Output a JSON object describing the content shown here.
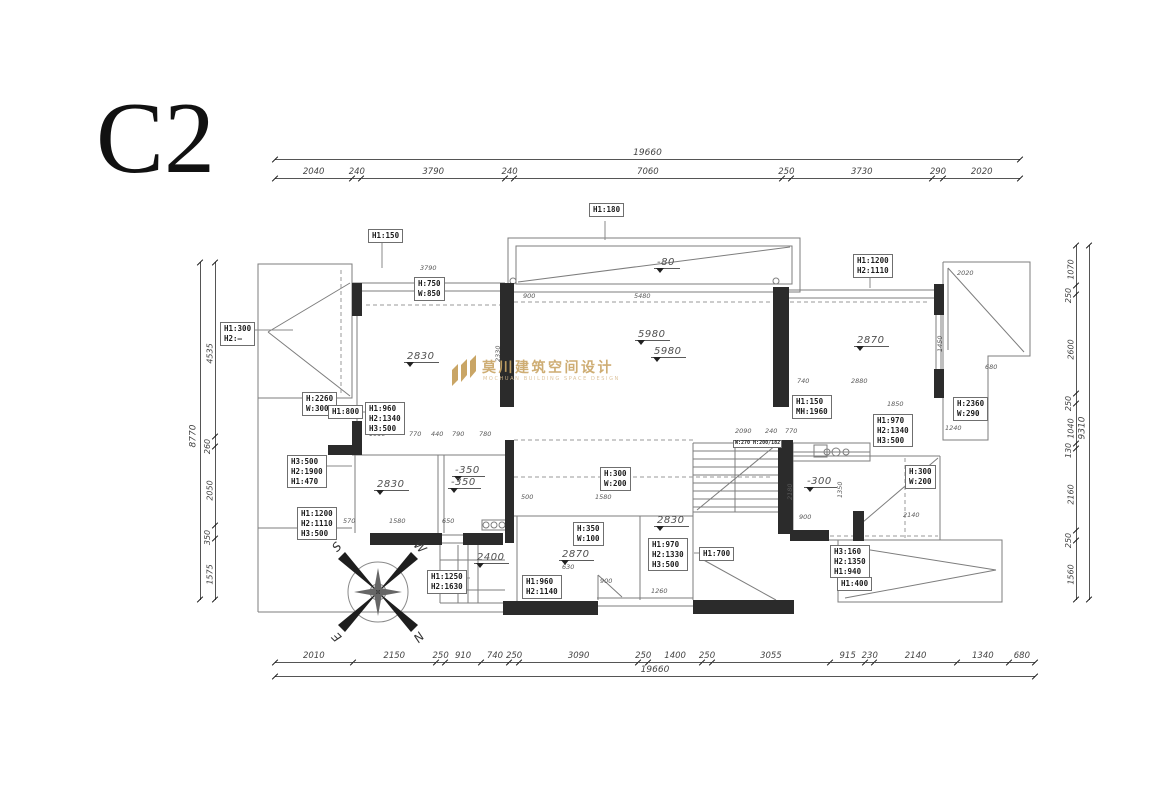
{
  "title": "C2",
  "watermark": {
    "logo_cn": "莫川建筑空间设计",
    "logo_en": "MOCHUAN BUILDING SPACE DESIGN",
    "color": "#c9a565"
  },
  "compass": {
    "s": "S",
    "w": "W",
    "e": "E",
    "n": "N"
  },
  "dimension_chains": {
    "top": {
      "total": "19660",
      "segments": [
        "2040",
        "240",
        "3790",
        "240",
        "7060",
        "250",
        "3730",
        "290",
        "2020"
      ]
    },
    "bottom": {
      "total": "19660",
      "segments": [
        "2010",
        "2150",
        "250",
        "910",
        "740",
        "250",
        "3090",
        "250",
        "1400",
        "250",
        "3055",
        "915",
        "230",
        "2140",
        "1340",
        "680"
      ]
    },
    "left": {
      "total": "8770",
      "segments": [
        "4535",
        "260",
        "2050",
        "350",
        "1575"
      ]
    },
    "right": {
      "total": "9310",
      "segments": [
        "1070",
        "250",
        "2600",
        "250",
        "1040",
        "130",
        "2160",
        "250",
        "1560"
      ]
    }
  },
  "callouts": [
    {
      "t": "H1:150",
      "x": 368,
      "y": 229
    },
    {
      "t": "H1:180",
      "x": 589,
      "y": 203
    },
    {
      "t": "H1:1200\nH2:1110",
      "x": 853,
      "y": 254
    },
    {
      "t": "H:750\nW:850",
      "x": 414,
      "y": 277
    },
    {
      "t": "H1:300\nH2:—",
      "x": 220,
      "y": 322
    },
    {
      "t": "H:2260\nW:300",
      "x": 302,
      "y": 392
    },
    {
      "t": "H1:800",
      "x": 328,
      "y": 405
    },
    {
      "t": "H1:960\nH2:1340\nH3:500",
      "x": 365,
      "y": 402
    },
    {
      "t": "H1:150\nMH:1960",
      "x": 792,
      "y": 395
    },
    {
      "t": "H:2360\nW:290",
      "x": 953,
      "y": 397
    },
    {
      "t": "H1:970\nH2:1340\nH3:500",
      "x": 873,
      "y": 414
    },
    {
      "t": "H3:500\nH2:1900\nH1:470",
      "x": 287,
      "y": 455
    },
    {
      "t": "H1:1200\nH2:1110\nH3:500",
      "x": 297,
      "y": 507
    },
    {
      "t": "H:300\nW:200",
      "x": 600,
      "y": 467
    },
    {
      "t": "H:300\nW:200",
      "x": 905,
      "y": 465
    },
    {
      "t": "H:350\nW:100",
      "x": 573,
      "y": 522
    },
    {
      "t": "H1:970\nH2:1330\nH3:500",
      "x": 648,
      "y": 538
    },
    {
      "t": "H1:700",
      "x": 699,
      "y": 547
    },
    {
      "t": "H1:1250\nH2:1630",
      "x": 427,
      "y": 570
    },
    {
      "t": "H1:960\nH2:1140",
      "x": 522,
      "y": 575
    },
    {
      "t": "H3:160\nH2:1350\nH1:940",
      "x": 830,
      "y": 545
    },
    {
      "t": "H1:400",
      "x": 837,
      "y": 577
    },
    {
      "t": "W:270 H:200/182",
      "x": 733,
      "y": 440,
      "s": 1
    }
  ],
  "level_marks": [
    {
      "v": "2830",
      "x": 404,
      "y": 351
    },
    {
      "v": "-80",
      "x": 654,
      "y": 257
    },
    {
      "v": "5980",
      "x": 635,
      "y": 329
    },
    {
      "v": "5980",
      "x": 651,
      "y": 346
    },
    {
      "v": "2870",
      "x": 854,
      "y": 335
    },
    {
      "v": "2830",
      "x": 374,
      "y": 479
    },
    {
      "v": "-350",
      "x": 452,
      "y": 465
    },
    {
      "v": "-350",
      "x": 448,
      "y": 477
    },
    {
      "v": "2870",
      "x": 559,
      "y": 549
    },
    {
      "v": "2830",
      "x": 654,
      "y": 515
    },
    {
      "v": "-300",
      "x": 804,
      "y": 476
    },
    {
      "v": "2400",
      "x": 474,
      "y": 552
    }
  ],
  "interior_dims": [
    {
      "t": "3790",
      "x": 420,
      "y": 264
    },
    {
      "t": "900",
      "x": 523,
      "y": 292
    },
    {
      "t": "5480",
      "x": 634,
      "y": 292
    },
    {
      "t": "2020",
      "x": 957,
      "y": 269
    },
    {
      "t": "680",
      "x": 985,
      "y": 363
    },
    {
      "t": "740",
      "x": 797,
      "y": 377
    },
    {
      "t": "2880",
      "x": 851,
      "y": 377
    },
    {
      "t": "1850",
      "x": 887,
      "y": 400
    },
    {
      "t": "1240",
      "x": 945,
      "y": 424
    },
    {
      "t": "2140",
      "x": 903,
      "y": 511
    },
    {
      "t": "900",
      "x": 799,
      "y": 513
    },
    {
      "t": "2090",
      "x": 735,
      "y": 427
    },
    {
      "t": "240",
      "x": 765,
      "y": 427
    },
    {
      "t": "770",
      "x": 785,
      "y": 427
    },
    {
      "t": "1010",
      "x": 369,
      "y": 430
    },
    {
      "t": "770",
      "x": 409,
      "y": 430
    },
    {
      "t": "440",
      "x": 431,
      "y": 430
    },
    {
      "t": "790",
      "x": 452,
      "y": 430
    },
    {
      "t": "780",
      "x": 479,
      "y": 430
    },
    {
      "t": "570",
      "x": 343,
      "y": 517
    },
    {
      "t": "1580",
      "x": 389,
      "y": 517
    },
    {
      "t": "650",
      "x": 442,
      "y": 517
    },
    {
      "t": "500",
      "x": 521,
      "y": 493
    },
    {
      "t": "1580",
      "x": 595,
      "y": 493
    },
    {
      "t": "630",
      "x": 562,
      "y": 563
    },
    {
      "t": "900",
      "x": 600,
      "y": 577
    },
    {
      "t": "1260",
      "x": 651,
      "y": 587
    },
    {
      "t": "2180",
      "x": 786,
      "y": 500,
      "r": 1
    },
    {
      "t": "1350",
      "x": 836,
      "y": 498,
      "r": 1
    },
    {
      "t": "1450",
      "x": 936,
      "y": 352,
      "r": 1
    },
    {
      "t": "2330",
      "x": 494,
      "y": 362,
      "r": 1
    }
  ]
}
